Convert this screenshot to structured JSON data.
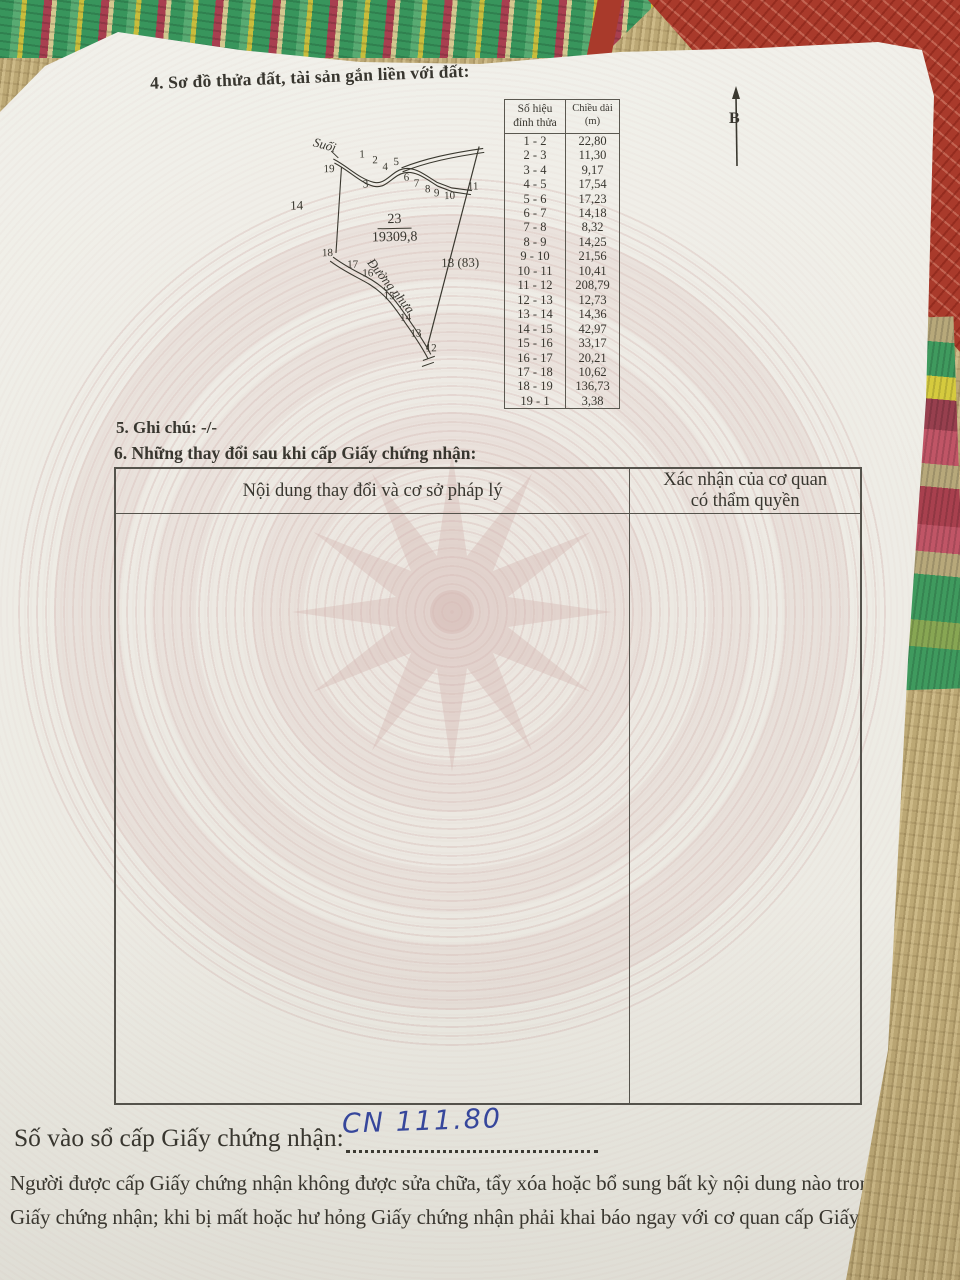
{
  "colors": {
    "mat_tan": "#c2ae7c",
    "mat_red_border": "#a93a2b",
    "stripe_green": "#3f9a5e",
    "stripe_yellow": "#d5ca3e",
    "stripe_maroon": "#973f4e",
    "paper": "#f0efe9",
    "drum_pattern_pink": "#d6bab6",
    "ink_text": "#38362f",
    "handwriting_blue": "#3547a0"
  },
  "page": {
    "section4_title": "4. Sơ đồ thửa đất, tài sản gắn liền với đất:",
    "north_label": "B",
    "section5_note": "5. Ghi chú: -/-",
    "section6_title": "6. Những thay đổi sau khi cấp Giấy chứng nhận:",
    "registry_label": "Số vào sổ cấp Giấy chứng nhận:",
    "registry_value": "CN 111.80",
    "footer_warning": "Người được cấp Giấy chứng nhận không được sửa chữa, tẩy xóa hoặc bổ sung bất kỳ nội dung nào trong\nGiấy chứng nhận; khi bị mất hoặc hư hỏng Giấy chứng nhận phải khai báo ngay với cơ quan cấp Giấy."
  },
  "measure_table": {
    "col1_header": "Số hiệu\nđỉnh thửa",
    "col2_header": "Chiều dài\n(m)",
    "rows": [
      {
        "seg": "1 - 2",
        "len": "22,80"
      },
      {
        "seg": "2 - 3",
        "len": "11,30"
      },
      {
        "seg": "3 - 4",
        "len": "9,17"
      },
      {
        "seg": "4 - 5",
        "len": "17,54"
      },
      {
        "seg": "5 - 6",
        "len": "17,23"
      },
      {
        "seg": "6 - 7",
        "len": "14,18"
      },
      {
        "seg": "7 - 8",
        "len": "8,32"
      },
      {
        "seg": "8 - 9",
        "len": "14,25"
      },
      {
        "seg": "9 - 10",
        "len": "21,56"
      },
      {
        "seg": "10 - 11",
        "len": "10,41"
      },
      {
        "seg": "11 - 12",
        "len": "208,79"
      },
      {
        "seg": "12 - 13",
        "len": "12,73"
      },
      {
        "seg": "13 - 14",
        "len": "14,36"
      },
      {
        "seg": "14 - 15",
        "len": "42,97"
      },
      {
        "seg": "15 - 16",
        "len": "33,17"
      },
      {
        "seg": "16 - 17",
        "len": "20,21"
      },
      {
        "seg": "17 - 18",
        "len": "10,62"
      },
      {
        "seg": "18 - 19",
        "len": "136,73"
      },
      {
        "seg": "19 - 1",
        "len": "3,38"
      }
    ]
  },
  "diagram": {
    "stream_label": "Suối",
    "road_label": "Đường nhựa",
    "parcel_number": "23",
    "parcel_area": "19309,8",
    "adjacent_parcel_left": "14",
    "adjacent_parcel_right": "18 (83)",
    "vertices": [
      {
        "n": "19",
        "x": 50,
        "y": 34
      },
      {
        "n": "1",
        "x": 86,
        "y": 20
      },
      {
        "n": "2",
        "x": 99,
        "y": 26
      },
      {
        "n": "4",
        "x": 109,
        "y": 33
      },
      {
        "n": "5",
        "x": 120,
        "y": 28
      },
      {
        "n": "3",
        "x": 89,
        "y": 50
      },
      {
        "n": "6",
        "x": 130,
        "y": 44
      },
      {
        "n": "7",
        "x": 140,
        "y": 50
      },
      {
        "n": "8",
        "x": 151,
        "y": 56
      },
      {
        "n": "9",
        "x": 160,
        "y": 60
      },
      {
        "n": "10",
        "x": 170,
        "y": 63
      },
      {
        "n": "11",
        "x": 194,
        "y": 54
      },
      {
        "n": "18",
        "x": 47,
        "y": 118
      },
      {
        "n": "17",
        "x": 72,
        "y": 130
      },
      {
        "n": "16",
        "x": 87,
        "y": 139
      },
      {
        "n": "15",
        "x": 108,
        "y": 162
      },
      {
        "n": "14",
        "x": 124,
        "y": 184
      },
      {
        "n": "13",
        "x": 134,
        "y": 200
      },
      {
        "n": "12",
        "x": 149,
        "y": 215
      }
    ]
  },
  "changes_table": {
    "col1_header": "Nội dung thay đổi và cơ sở pháp lý",
    "col2_header": "Xác nhận của cơ quan\ncó thẩm quyền"
  }
}
